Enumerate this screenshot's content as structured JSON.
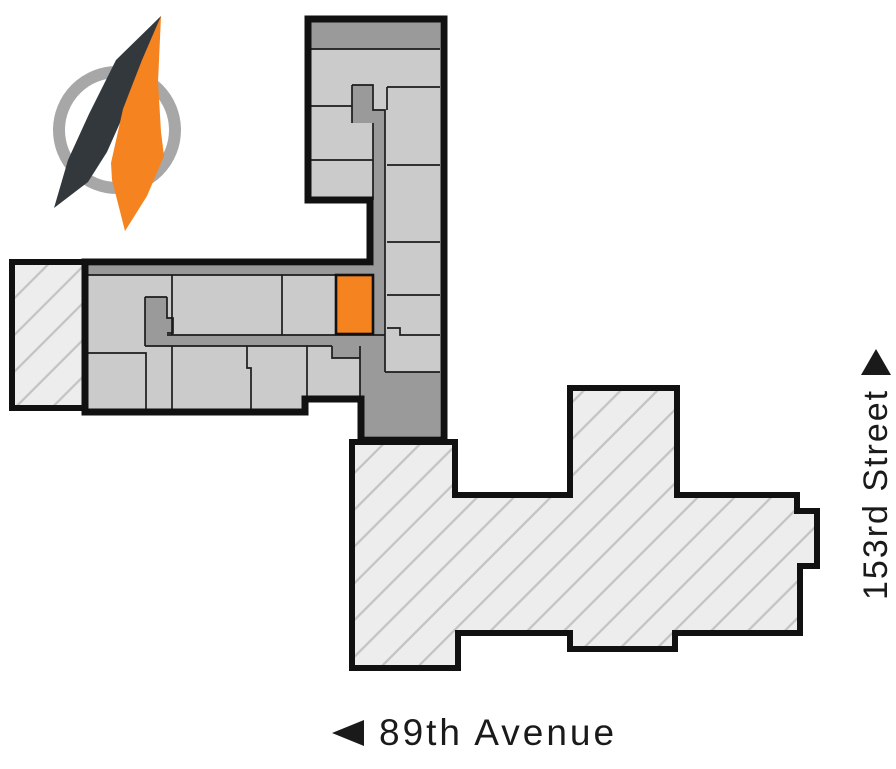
{
  "page": {
    "type": "site-floor-plan-diagram",
    "background": "#ffffff"
  },
  "labels": {
    "street_right": "153rd Street",
    "street_bottom": "89th Avenue"
  },
  "icons": {
    "street_right_arrow": "triangle-up",
    "street_bottom_arrow": "triangle-left",
    "compass": "compass-needle"
  },
  "colors": {
    "unit_fill": "#cbcbcb",
    "corridor_fill": "#9a9a9a",
    "outline": "#111111",
    "thin_line": "#1c1c1c",
    "highlight_unit": "#f5831f",
    "hatch_background": "#ededed",
    "hatch_line": "#c3c3c3",
    "compass_ring": "#a7a7a7",
    "compass_dark": "#33383d",
    "compass_orange": "#f5831f",
    "label_text": "#1a1a1a"
  },
  "plan": {
    "highlighted_unit": {
      "x": 336,
      "y": 275,
      "width": 37,
      "height": 59
    },
    "buildings": [
      "main-building-l-shape",
      "west-annex-hatched",
      "south-building-hatched"
    ]
  }
}
